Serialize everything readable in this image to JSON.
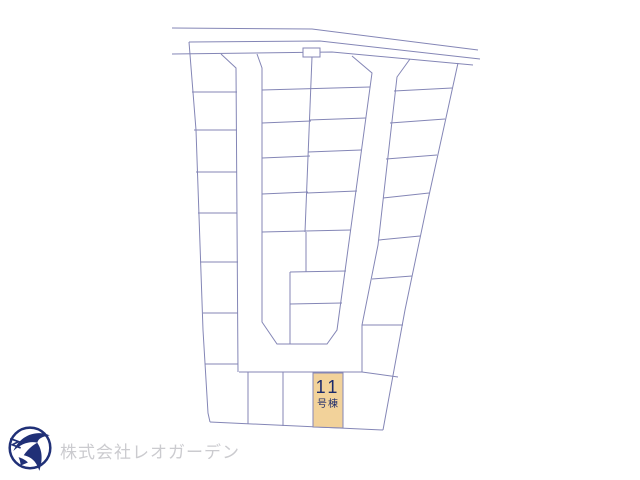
{
  "site_plan": {
    "line_color": "#8486b6",
    "highlighted_lot": {
      "number": "11",
      "label": "号棟",
      "fill_color": "#f2d29a",
      "text_color": "#1c2a6b"
    }
  },
  "footer": {
    "company_name": "株式会社レオガーデン",
    "company_text_color": "#cbcbcf",
    "logo_icon": "bird-in-circle-logo",
    "logo_color": "#203077"
  }
}
